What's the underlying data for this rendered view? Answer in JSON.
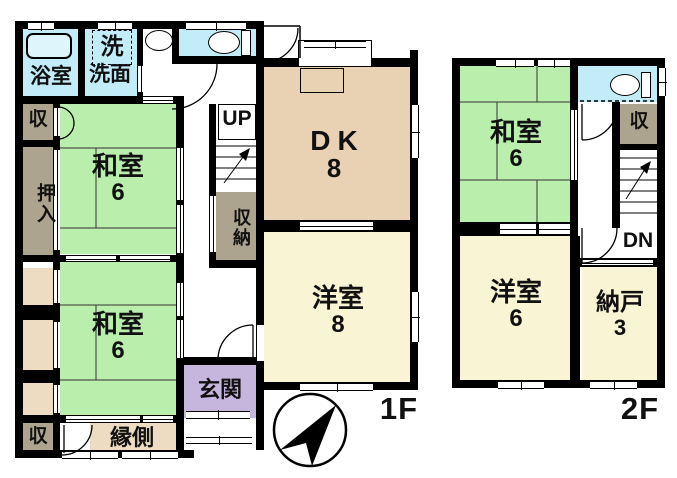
{
  "colors": {
    "wall": "#000000",
    "tatami": "#b9eead",
    "water": "#c2ecf7",
    "wood": "#e9d2b4",
    "western": "#f9f4d3",
    "entry": "#c5b6de",
    "storage": "#aca48f",
    "veranda": "#eedcc2",
    "bg": "#ffffff"
  },
  "floor1": {
    "plate_label": "1F",
    "rooms": {
      "bath": {
        "label": "浴室"
      },
      "laundry": {
        "label": "洗"
      },
      "washroom": {
        "label": "洗面"
      },
      "storage_top": {
        "label": "収"
      },
      "oshiire": {
        "label": "押入"
      },
      "washitsu_a": {
        "label": "和室",
        "size": "6"
      },
      "washitsu_b": {
        "label": "和室",
        "size": "6"
      },
      "dk": {
        "label": "DK",
        "size": "8"
      },
      "youshitsu": {
        "label": "洋室",
        "size": "8"
      },
      "stairs": {
        "label": "UP"
      },
      "closet": {
        "label": "収納"
      },
      "genkan": {
        "label": "玄関"
      },
      "engawa": {
        "label": "縁側"
      },
      "storage_bottom": {
        "label": "収"
      }
    }
  },
  "floor2": {
    "plate_label": "2F",
    "rooms": {
      "washitsu": {
        "label": "和室",
        "size": "6"
      },
      "storage": {
        "label": "収"
      },
      "stairs": {
        "label": "DN"
      },
      "youshitsu": {
        "label": "洋室",
        "size": "6"
      },
      "nando": {
        "label": "納戸",
        "size": "3"
      }
    }
  }
}
